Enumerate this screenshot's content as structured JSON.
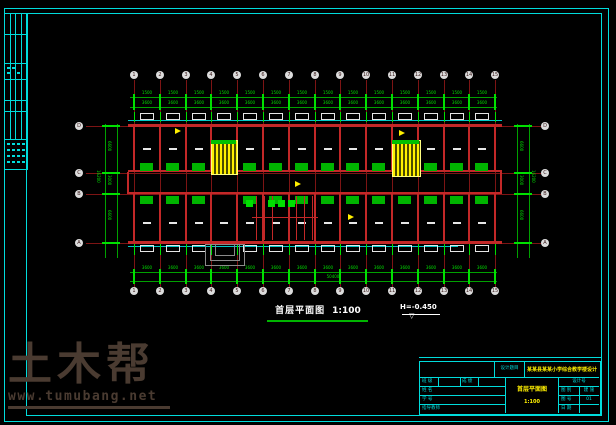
{
  "watermark": {
    "brand": "土木帮",
    "url": "www.tumubang.net"
  },
  "caption": {
    "title": "首层平面图",
    "scale": "1:100"
  },
  "level_mark": {
    "value": "H=-0.450"
  },
  "grid": {
    "cols": [
      "1",
      "2",
      "3",
      "4",
      "5",
      "6",
      "7",
      "8",
      "9",
      "10",
      "11",
      "12",
      "13",
      "14",
      "15"
    ],
    "rows": [
      "D",
      "C",
      "B",
      "A"
    ]
  },
  "dims": {
    "opening": "1500",
    "bay": "3600",
    "total": "50400",
    "left_bays": [
      "6600",
      "3000",
      "6600"
    ],
    "left_total": "16200"
  },
  "title_block": {
    "project_label": "设计题目",
    "project_name": "某某县某某小学综合教学楼设计",
    "drawing_name": "首层平面图",
    "drawing_scale": "1:100",
    "left_rows": [
      {
        "label": "班 级",
        "label2": "成 绩"
      },
      {
        "label": "姓 名"
      },
      {
        "label": "学 号"
      },
      {
        "label": "指导教师"
      }
    ],
    "right_header": "设计号",
    "right_rows": [
      {
        "label": "图 别",
        "value": "建 施"
      },
      {
        "label": "图 号",
        "value": "01"
      },
      {
        "label": "日 期",
        "value": ""
      }
    ]
  },
  "colors": {
    "frame": "#00dcdc",
    "axis": "#7d1414",
    "wall": "#c32828",
    "wallface": "#00c8c8",
    "dimension": "#00a000",
    "highlight": "#00e000",
    "stair": "#ffef00",
    "white": "#e6e6e6",
    "watermark": "#4a3b31"
  }
}
